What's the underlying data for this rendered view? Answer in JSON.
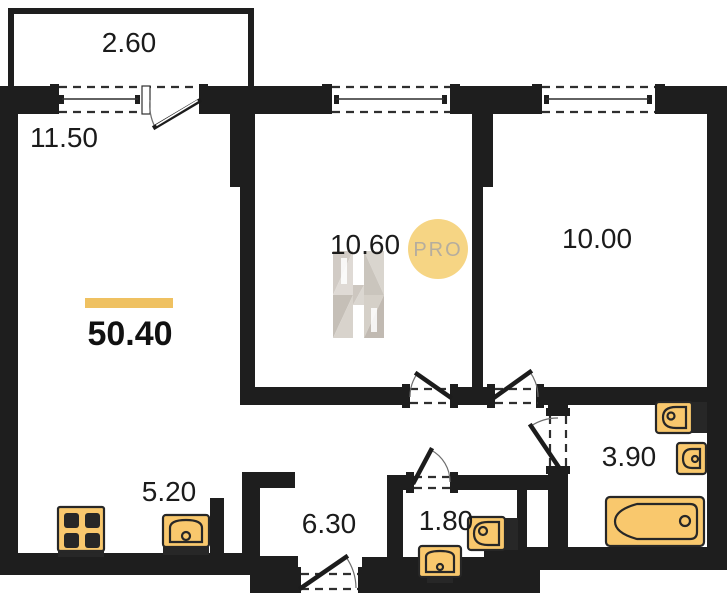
{
  "colors": {
    "wall": "#1E1E1E",
    "accent_bar": "#EFC161",
    "fixture_fill": "#F9C86D",
    "badge_fill": "#F6D584",
    "badge_text": "#B5AD9E"
  },
  "badge": {
    "label": "PRO"
  },
  "total_area": {
    "value": "50.40"
  },
  "rooms": {
    "balcony": {
      "area": "2.60"
    },
    "living": {
      "area": "11.50"
    },
    "bedroom_mid": {
      "area": "10.60"
    },
    "bedroom_right": {
      "area": "10.00"
    },
    "kitchen": {
      "area": "5.20"
    },
    "hallway": {
      "area": "6.30"
    },
    "wc": {
      "area": "1.80"
    },
    "bathroom": {
      "area": "3.90"
    }
  }
}
